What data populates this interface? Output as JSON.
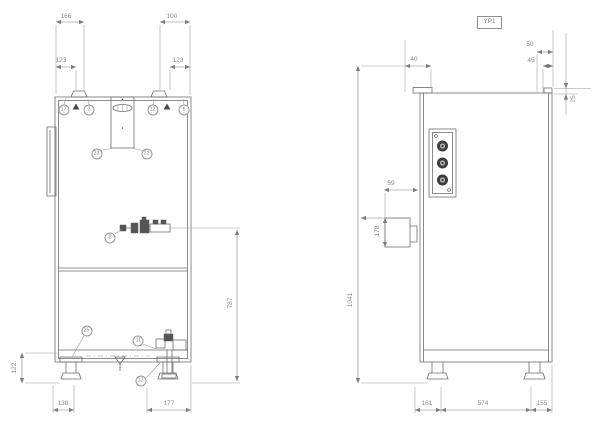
{
  "drawing": {
    "front_view": {
      "dims": {
        "top_left_outer": "166",
        "top_left_inner": "123",
        "top_right_outer": "100",
        "top_right_inner": "123",
        "valve_to_floor": "787",
        "base_height": "122",
        "bottom_left_foot": "138",
        "bottom_right": "177"
      },
      "balloons": {
        "top_left_a": "17",
        "top_left_b": "3",
        "top_right_a": "12",
        "top_right_b": "6",
        "plate_left": "23",
        "plate_right": "21",
        "mid_valve": "8",
        "base_left": "25",
        "drain_upper": "11",
        "drain_lower": "13"
      }
    },
    "side_view": {
      "label": "YP1",
      "dims": {
        "roof_step": "40",
        "front_top_outer": "50",
        "front_top_inner": "45",
        "front_offset": "25",
        "terminal_box_width": "59",
        "terminal_box_height": "178",
        "overall_height": "1041",
        "bottom_left": "161",
        "bottom_middle": "574",
        "bottom_right": "155"
      }
    }
  }
}
